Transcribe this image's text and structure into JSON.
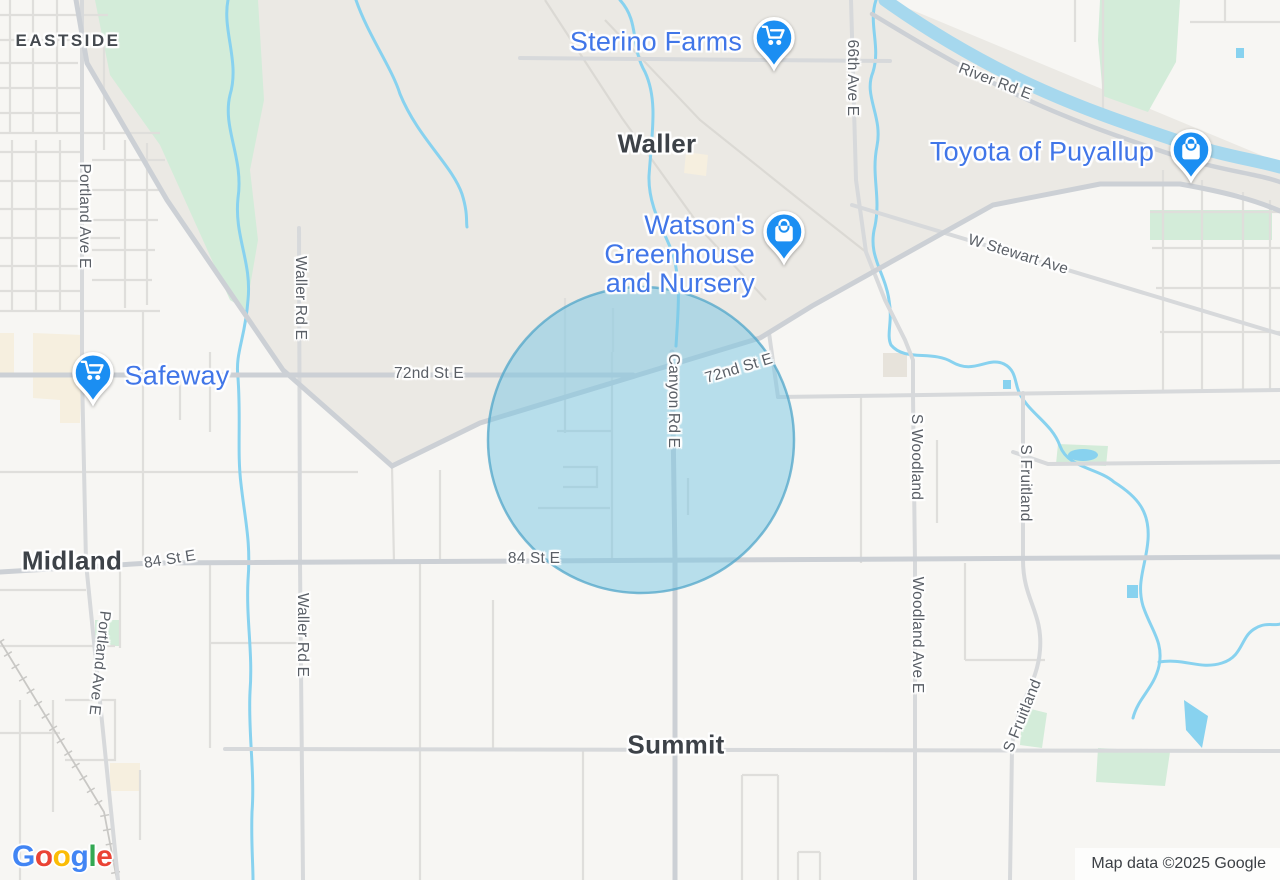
{
  "map": {
    "type": "road-map",
    "attribution": "Map data ©2025 Google",
    "logo": {
      "text": "Google",
      "letters": [
        "G",
        "o",
        "o",
        "g",
        "l",
        "e"
      ],
      "letter_colors": [
        "#4285F4",
        "#EA4335",
        "#FBBC05",
        "#4285F4",
        "#34A853",
        "#EA4335"
      ]
    },
    "towns": [
      {
        "id": "eastside",
        "text": "EASTSIDE"
      },
      {
        "id": "waller",
        "text": "Waller"
      },
      {
        "id": "midland",
        "text": "Midland"
      },
      {
        "id": "summit",
        "text": "Summit"
      }
    ],
    "road_labels": [
      {
        "id": "river-rd-e",
        "text": "River Rd E"
      },
      {
        "id": "66th-ave-e",
        "text": "66th Ave E"
      },
      {
        "id": "w-stewart-ave",
        "text": "W Stewart Ave"
      },
      {
        "id": "72nd-st-e-left",
        "text": "72nd St E"
      },
      {
        "id": "72nd-st-e-right",
        "text": "72nd St E"
      },
      {
        "id": "canyon-rd-e",
        "text": "Canyon Rd E"
      },
      {
        "id": "84-st-e-left",
        "text": "84 St E"
      },
      {
        "id": "84-st-e-center",
        "text": "84 St E"
      },
      {
        "id": "portland-ave-e-top",
        "text": "Portland Ave E"
      },
      {
        "id": "portland-ave-e-bottom",
        "text": "Portland Ave E"
      },
      {
        "id": "waller-rd-e-top",
        "text": "Waller Rd E"
      },
      {
        "id": "waller-rd-e-bottom",
        "text": "Waller Rd E"
      },
      {
        "id": "s-woodland",
        "text": "S Woodland"
      },
      {
        "id": "woodland-ave-e",
        "text": "Woodland Ave E"
      },
      {
        "id": "s-fruitland-top",
        "text": "S Fruitland"
      },
      {
        "id": "s-fruitland-bottom",
        "text": "S Fruitland"
      }
    ],
    "pois": [
      {
        "id": "sterino-farms",
        "label": "Sterino Farms",
        "icon": "shopping-cart-icon"
      },
      {
        "id": "watsons-greenhouse",
        "label_line1": "Watson's Greenhouse",
        "label_line2": "and Nursery",
        "icon": "shopping-bag-icon"
      },
      {
        "id": "toyota-of-puyallup",
        "label": "Toyota of Puyallup",
        "icon": "shopping-bag-icon"
      },
      {
        "id": "safeway",
        "label": "Safeway",
        "icon": "shopping-cart-icon"
      }
    ],
    "overlay": {
      "type": "radius-circle",
      "fill": "#77c5e4",
      "fill_opacity": 0.5,
      "stroke": "#50a6ca"
    },
    "colors": {
      "poi_label": "#4176e8",
      "road_label": "#5a5f66",
      "town_label": "#3d4248",
      "water": "#88d2ef",
      "pin": "#1b8ef2",
      "park_green": "#d3ecd9",
      "urban_area": "#ebe9e4"
    }
  }
}
